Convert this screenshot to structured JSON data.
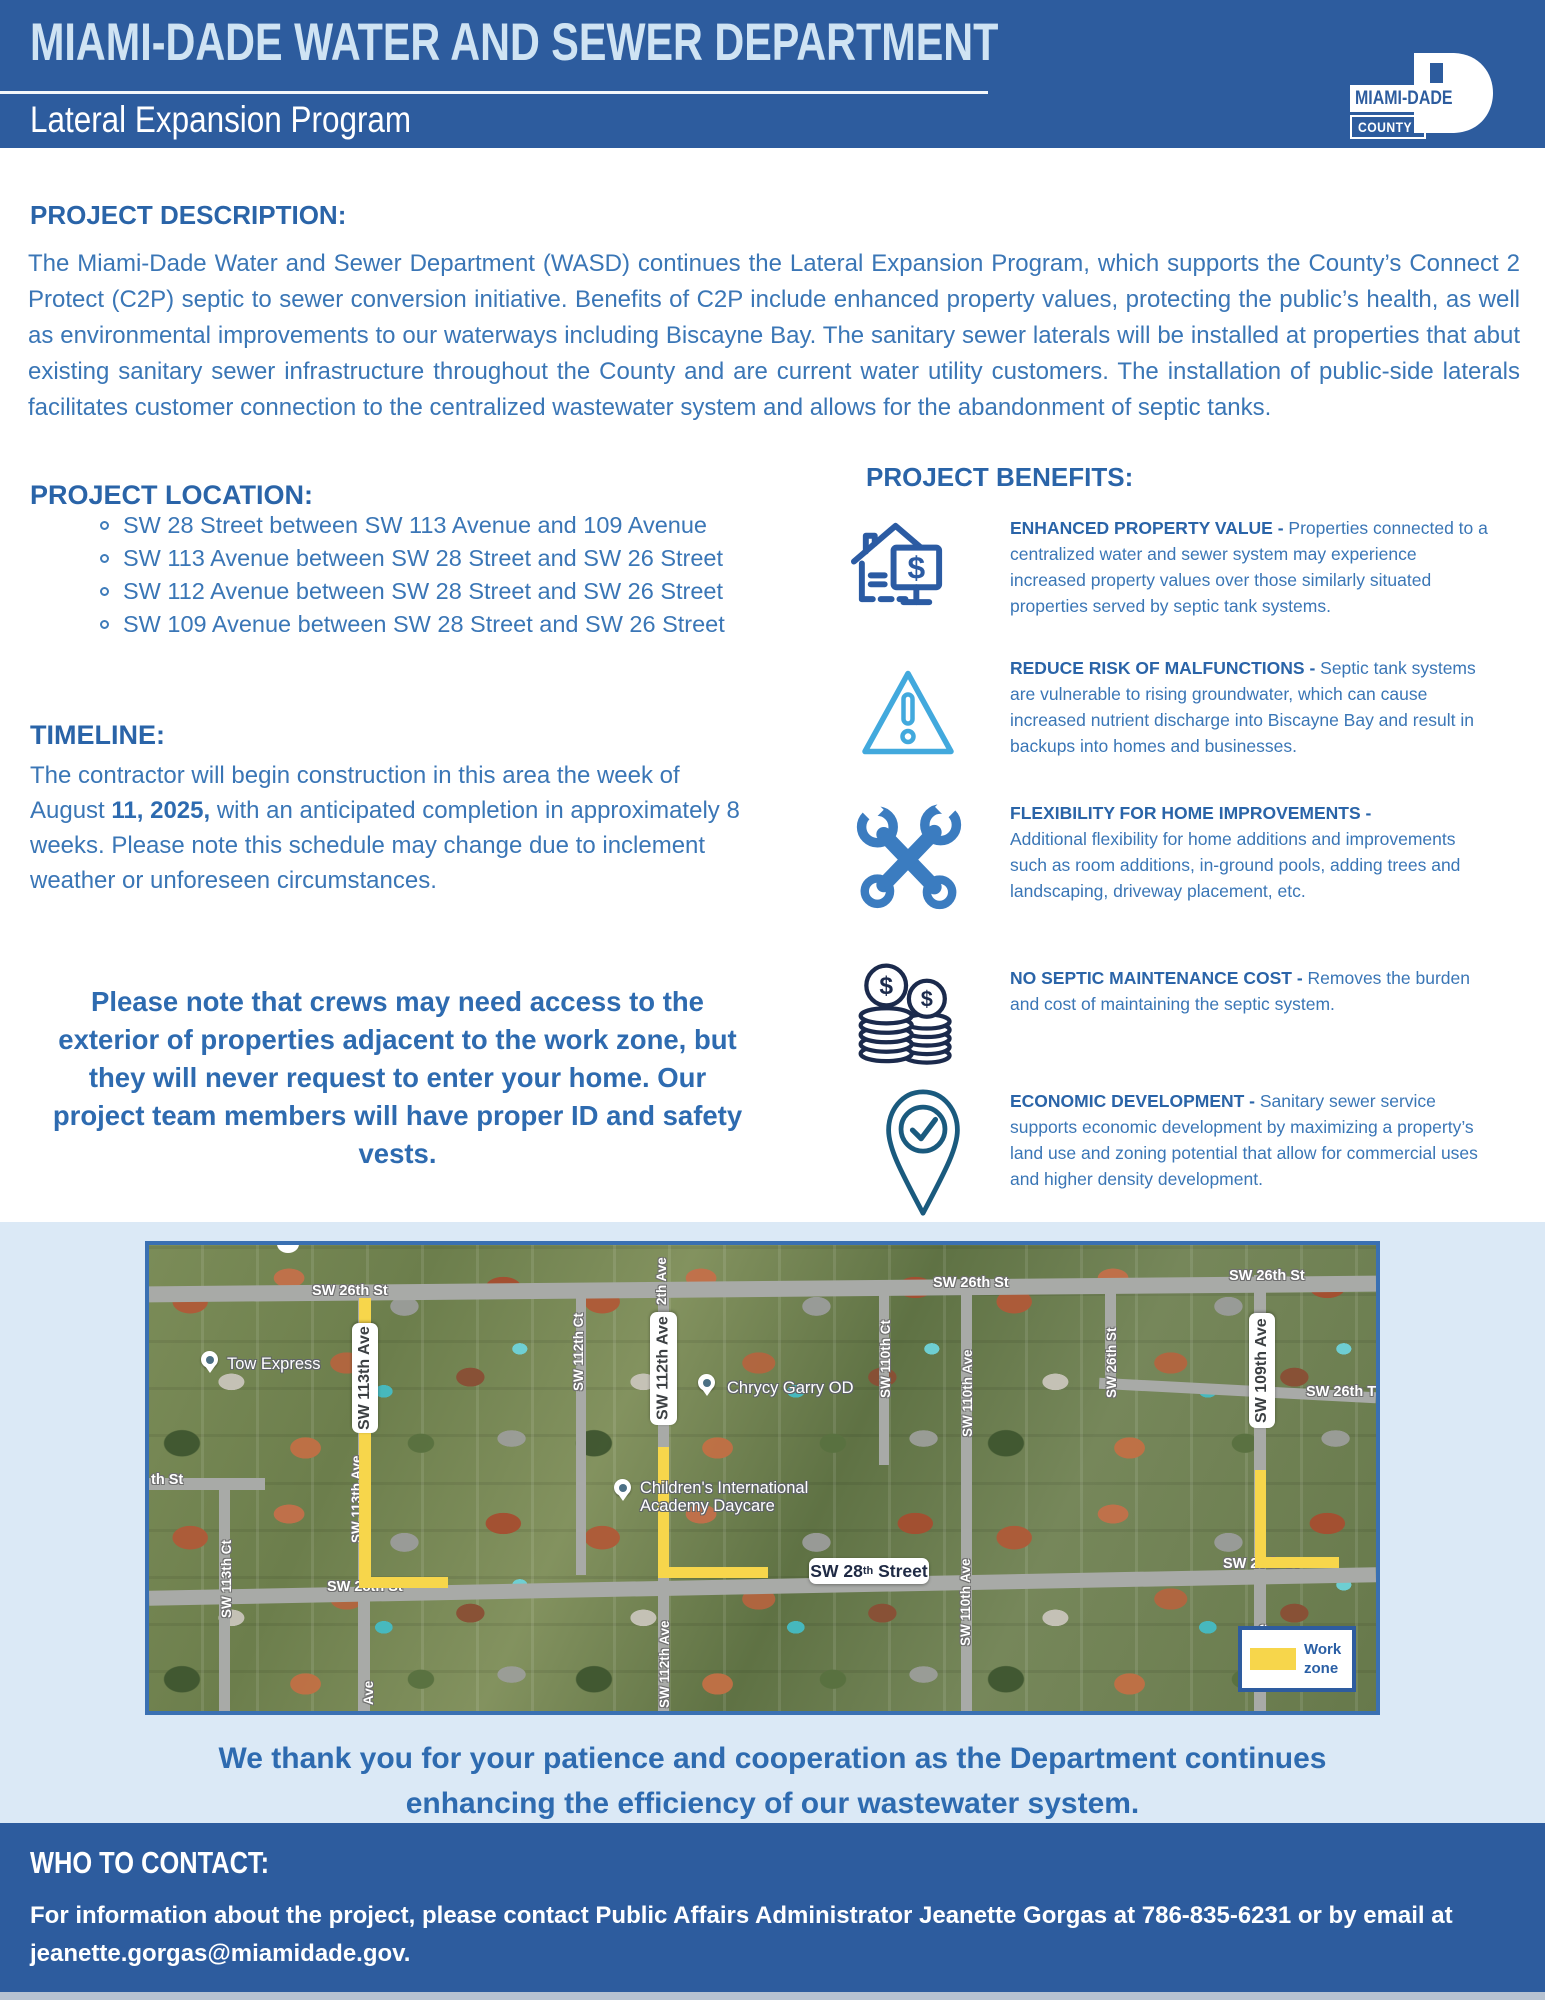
{
  "header": {
    "title": "MIAMI-DADE WATER AND SEWER DEPARTMENT",
    "subtitle": "Lateral Expansion Program",
    "logo": {
      "name": "MIAMI-DADE",
      "county": "COUNTY"
    }
  },
  "description": {
    "heading": "PROJECT DESCRIPTION:",
    "body": "The Miami-Dade Water and Sewer Department (WASD) continues the Lateral Expansion Program, which supports the County’s Connect 2 Protect (C2P) septic to sewer conversion initiative. Benefits of C2P include enhanced property values, protecting the public’s health, as well as environmental improvements to our waterways including Biscayne Bay. The sanitary sewer laterals will be installed at properties that abut existing sanitary sewer infrastructure throughout the County and are current water utility customers. The installation of public-side laterals facilitates customer connection to the centralized wastewater system and allows for the abandonment of septic tanks."
  },
  "location": {
    "heading": "PROJECT LOCATION:",
    "items": [
      "SW 28 Street between SW 113 Avenue and 109 Avenue",
      "SW 113 Avenue between SW 28 Street and SW 26 Street",
      "SW 112 Avenue between SW 28 Street and SW 26 Street",
      "SW 109 Avenue between SW 28 Street and SW 26 Street"
    ]
  },
  "timeline": {
    "heading": "TIMELINE:",
    "before": "The contractor will begin construction in this area the week of August ",
    "bold": "11, 2025,",
    "after": " with an anticipated completion in approximately 8 weeks. Please note this schedule may change due to inclement weather or unforeseen circumstances."
  },
  "notice": "Please note that crews may need access to the exterior of properties adjacent to the work zone, but they will never request to enter your home. Our project team members will have proper ID and safety vests.",
  "benefits": {
    "heading": "PROJECT BENEFITS:",
    "items": [
      {
        "icon": "house-dollar-icon",
        "title": "ENHANCED PROPERTY VALUE -",
        "text": " Properties connected to a centralized water and sewer system may experience increased property values over those similarly situated properties served by septic tank systems."
      },
      {
        "icon": "warning-triangle-icon",
        "title": "REDUCE RISK OF MALFUNCTIONS -",
        "text": " Septic tank systems are vulnerable to rising groundwater, which can cause increased nutrient discharge into Biscayne Bay and result in backups into homes and businesses."
      },
      {
        "icon": "tools-icon",
        "title": "FLEXIBILITY FOR HOME IMPROVEMENTS -",
        "text": "Additional flexibility for home additions and improvements such as room additions, in-ground pools, adding trees and landscaping, driveway placement, etc."
      },
      {
        "icon": "coins-icon",
        "title": "NO SEPTIC MAINTENANCE COST -",
        "text": " Removes the burden and cost of maintaining the septic system."
      },
      {
        "icon": "location-check-icon",
        "title": "ECONOMIC DEVELOPMENT -",
        "text": " Sanitary sewer service supports economic development by maximizing a property’s land use and zoning potential that allow for commercial uses and higher density development."
      }
    ]
  },
  "map": {
    "labels": [
      "SW 26th St",
      "SW 26th St",
      "SW 26th St",
      "SW 26th T",
      "SW 26th St",
      "2th Ave",
      "SW 112th Ct",
      "SW 113th Ct",
      "th St",
      "SW 110th Ct",
      "SW 110th Ave",
      "SW 110th Ave",
      "SW 28th St",
      "SW 28th St",
      "Ave",
      "SW 112th Ave",
      "SW 113th Ave",
      "ve"
    ],
    "pills": {
      "sw113": "SW 113th Ave",
      "sw112": "SW 112th Ave",
      "sw109": "SW 109th Ave",
      "sw28_prefix": "SW 28",
      "sw28_sup": "th",
      "sw28_suffix": " Street"
    },
    "pois": {
      "tow": "Tow Express",
      "chrycy": "Chrycy Garry OD",
      "daycare_line1": "Children's International",
      "daycare_line2": "Academy Daycare"
    },
    "legend": "Work zone"
  },
  "thanks": {
    "line1": "We thank you for your patience and cooperation as the Department continues",
    "line2": "enhancing the efficiency of our wastewater system."
  },
  "contact": {
    "heading": "WHO TO CONTACT:",
    "body": "For information about the project, please contact Public Affairs Administrator Jeanette Gorgas at 786-835-6231 or by email at jeanette.gorgas@miamidade.gov."
  }
}
